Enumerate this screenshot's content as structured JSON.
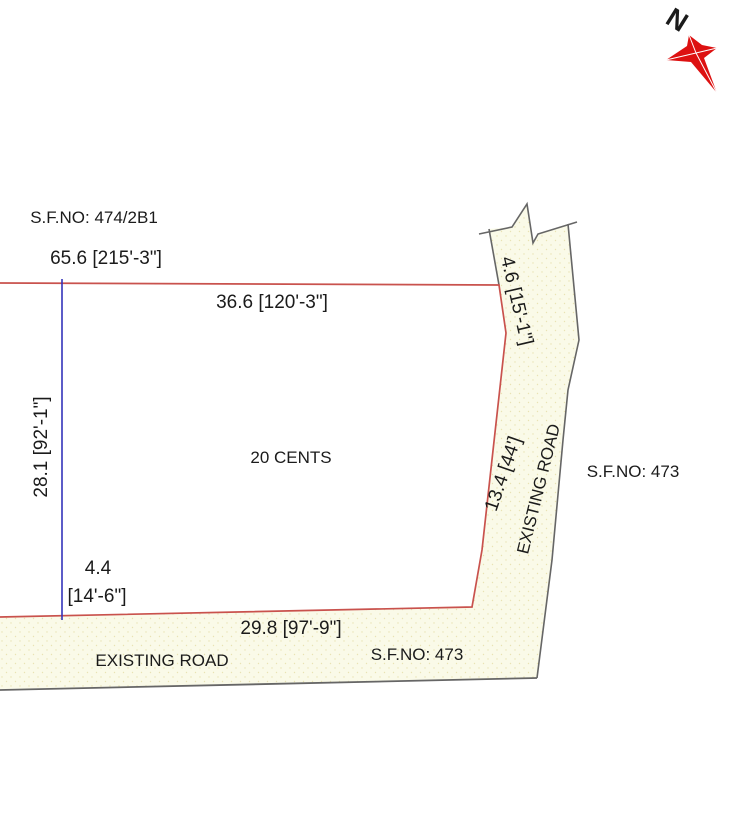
{
  "title": "Land survey plot sketch",
  "compass": {
    "label": "N"
  },
  "plot": {
    "area_label": "20 CENTS"
  },
  "labels": {
    "sf_no_top": "S.F.NO: 474/2B1",
    "dim_total_top": "65.6 [215'-3\"]",
    "dim_top": "36.6 [120'-3\"]",
    "dim_right_top": "4.6 [15'-1\"]",
    "dim_left": "28.1 [92'-1\"]",
    "dim_right": "13.4 [44']",
    "road_right": "EXISTING ROAD",
    "sf_no_right": "S.F.NO: 473",
    "dim_bottom_left_value": "4.4",
    "dim_bottom_left_feet": "[14'-6\"]",
    "dim_bottom": "29.8 [97'-9\"]",
    "sf_no_bottom": "S.F.NO: 473",
    "road_bottom": "EXISTING ROAD"
  },
  "colors": {
    "boundary_red": "#c9524d",
    "subdivision_blue": "#3333bb",
    "road_edge_gray": "#666666",
    "road_fill": "#fafae8",
    "road_stipple": "#e9e3b4",
    "compass_red": "#dd1111",
    "text": "#1b1b1b",
    "background": "#ffffff"
  }
}
